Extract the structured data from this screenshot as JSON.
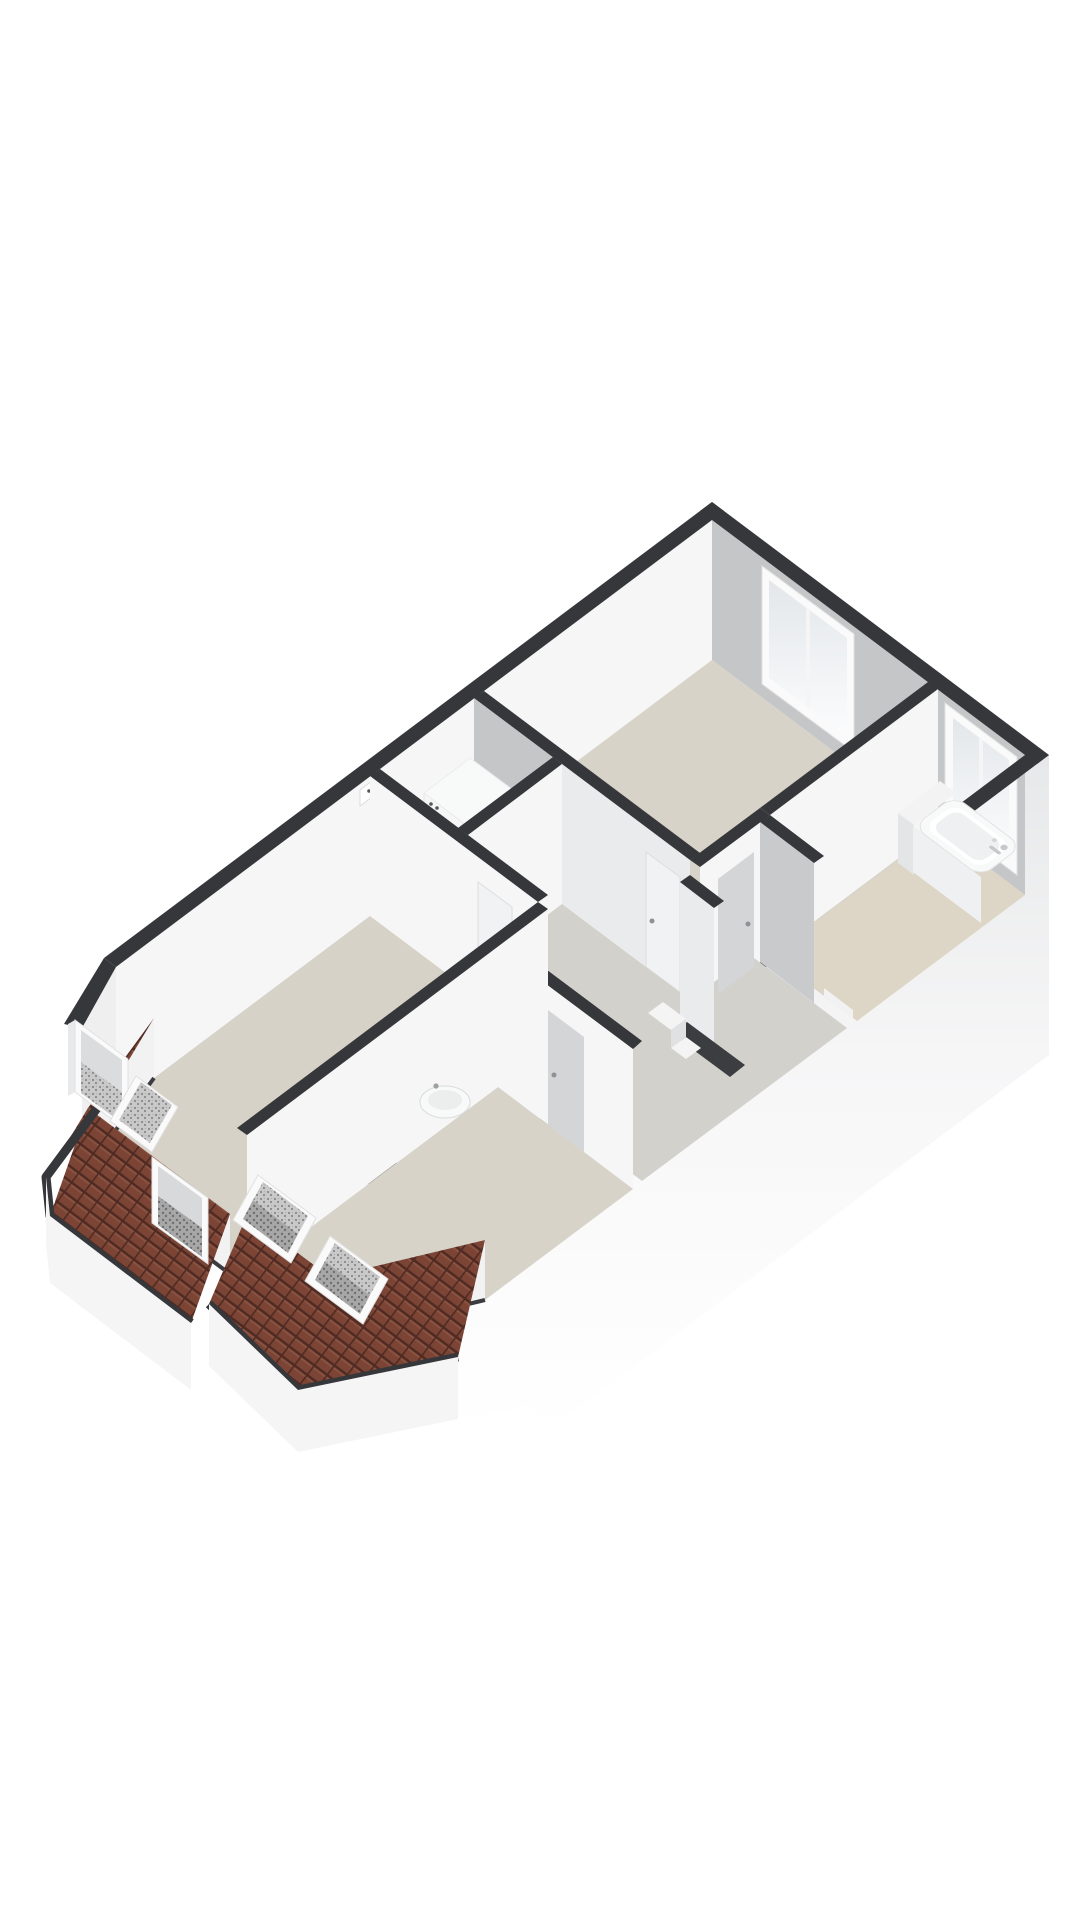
{
  "meta": {
    "description": "3D isometric floor-plan render of an attic storey: large bedroom top, bathroom right, laundry closet, central landing with stairs, two sloped-roof bedrooms with dormer and roof windows",
    "background": "#ffffff"
  },
  "colors": {
    "wallTop": "#36373b",
    "wallWhite": "#f6f6f7",
    "wallGreyInner": "#c5c6c8",
    "wallGreyLight": "#eaebec",
    "kneeWhite": "#f2f2f3",
    "floorMain": "#d7d3c8",
    "floorBath": "#ddd6c6",
    "floorHall": "#d3d1cb",
    "floorBed": "#d6d2c7",
    "floorCloset": "#d4d2cd",
    "roofTile": "#7b4434",
    "roofTileDark": "#502b24",
    "roofTileLight": "#8a5240",
    "frameWhite": "#fafafa",
    "doorGrey": "#d4d5d7",
    "doorWhite": "#f1f2f3",
    "fixtureWhite": "#f8f9f9",
    "stepFront": "#e0e1e3",
    "extTop": "#e7e8e9",
    "extMid": "#f6f6f7",
    "extEnd": "#ffffff",
    "eaves": "#f5f5f6",
    "glassTop": "#e3e7ea",
    "glassBottom": "#fbfcfd",
    "speckleBase": "#c9c9c9",
    "speckleDot": "#8a8a8a",
    "speckleDarkBase": "#a7a7a8",
    "speckleDarkDot": "#6f6f70",
    "handle": "#909194",
    "applianceDark": "#55565a"
  },
  "inventory": {
    "rooms": [
      "top-bedroom",
      "bathroom",
      "landing-hallway",
      "laundry-closet",
      "left-bedroom",
      "bottom-bedroom"
    ],
    "fixtures": [
      "washing-machine",
      "power-outlet",
      "bathtub",
      "bath-platform",
      "wall-sink",
      "staircase-steps"
    ],
    "windows": {
      "facade-casement-windows": 2,
      "vertical-dormer-windows": 2,
      "tilted-roof-windows": 3
    },
    "doors": 4
  }
}
